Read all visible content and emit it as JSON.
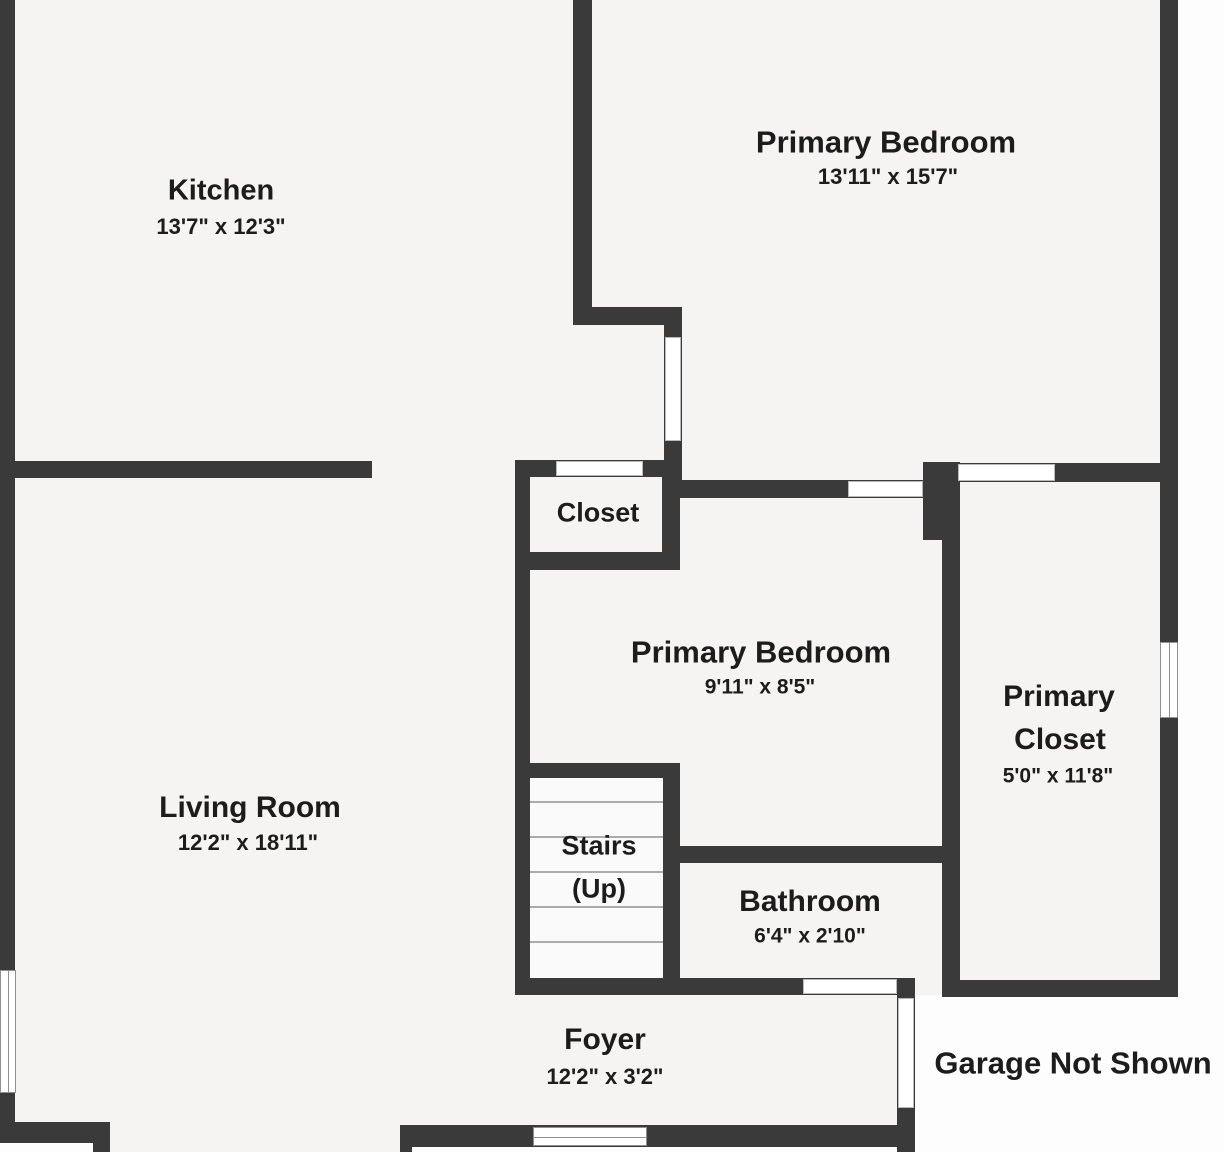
{
  "title": "First floor plan",
  "colors": {
    "wall": "#3a3a3a",
    "floor": "#f5f4f2",
    "outside": "#fdfdfd",
    "ink": "#1c1c1c",
    "window-border": "#8f8f8f",
    "door-border": "#b9b9b9",
    "tread": "#ababab",
    "stairwell": "#fafafa"
  },
  "rooms": {
    "kitchen": {
      "name": "Kitchen",
      "dims": "13'7\" x 12'3\""
    },
    "primary_bedroom_upper": {
      "name": "Primary Bedroom",
      "dims": "13'11\" x 15'7\""
    },
    "closet": {
      "name": "Closet"
    },
    "primary_bedroom_lower": {
      "name": "Primary Bedroom",
      "dims": "9'11\" x 8'5\""
    },
    "primary_closet": {
      "name_line1": "Primary",
      "name_line2": "Closet",
      "dims": "5'0\" x 11'8\""
    },
    "living_room": {
      "name": "Living Room",
      "dims": "12'2\" x 18'11\""
    },
    "stairs": {
      "name_line1": "Stairs",
      "name_line2": "(Up)"
    },
    "bathroom": {
      "name": "Bathroom",
      "dims": "6'4\" x 2'10\""
    },
    "foyer": {
      "name": "Foyer",
      "dims": "12'2\" x 3'2\""
    }
  },
  "annotations": {
    "garage_note": "Garage Not Shown"
  }
}
